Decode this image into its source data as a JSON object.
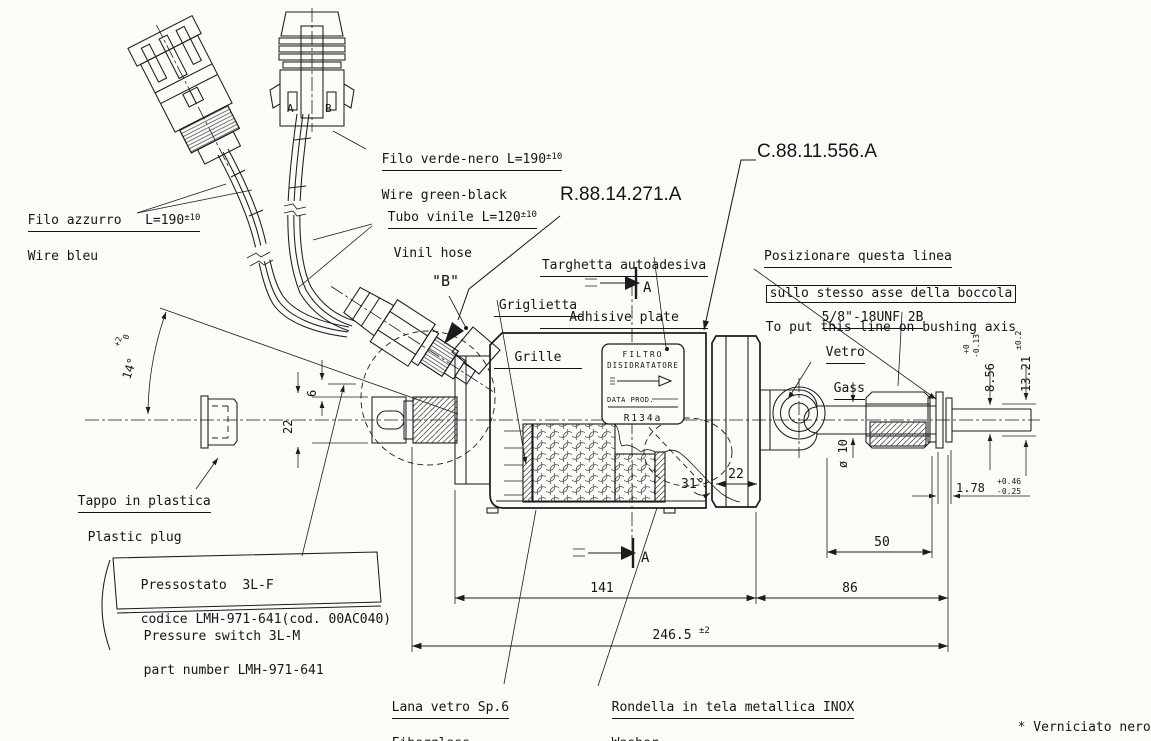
{
  "callouts": {
    "part_number_switch": "R.88.14.271.A",
    "part_number_filter": "C.88.11.556.A",
    "filo_azzurro_it": "Filo azzurro   ",
    "filo_azzurro_len": "L=190",
    "filo_azzurro_tol": "±10",
    "filo_azzurro_en": "Wire bleu",
    "filo_verde_it": "Filo verde-nero ",
    "filo_verde_len": "L=190",
    "filo_verde_tol": "±10",
    "filo_verde_en": "Wire green-black",
    "tubo_it": "Tubo vinile ",
    "tubo_len": "L=120",
    "tubo_tol": "±10",
    "tubo_en": "Vinil hose",
    "targhetta_it": "Targhetta autoadesiva",
    "targhetta_en": "Adhisive plate",
    "griglietta_it": "Griglietta",
    "griglietta_en": "Grille",
    "detail_b": "\"B\"",
    "posizionare_l1": "Posizionare questa linea",
    "posizionare_l2": "sullo stesso asse della boccola",
    "posizionare_l3": "To put this line on bushing axis",
    "thread_spec": "5/8\"-18UNF 2B",
    "vetro_it": "Vetro",
    "vetro_en": "Gass",
    "tappo_it": "Tappo in plastica",
    "tappo_en": "Plastic plug",
    "pressostato_l1": "Pressostato  3L-F",
    "pressostato_l2": "codice LMH-971-641(cod. 00AC040)",
    "pressostato_en1": "Pressure switch 3L-M",
    "pressostato_en2": "part number LMH-971-641",
    "lana_it": "Lana vetro Sp.6",
    "lana_en": "Fiberglass",
    "rondella_it": "Rondella in tela metallica INOX",
    "rondella_en": "Washer",
    "note_star_it": "* Verniciato nero",
    "note_star_en": "Black painted"
  },
  "plate": {
    "l1": "FILTRO",
    "l2": "DISIDRATATORE",
    "l3": "DATA PROD.",
    "l4": "R134a"
  },
  "connector": {
    "pin_a": "A",
    "pin_b": "B"
  },
  "section": {
    "label": "A"
  },
  "dims": {
    "len_body": "141",
    "len_right": "86",
    "len_total": "246.5",
    "len_total_tol": "±2",
    "len_pipe": "50",
    "cap_width": "22",
    "angle_cone": "31°",
    "pipe_dia": "ø 10",
    "d856": "8.56",
    "d856_tol_up": "+0",
    "d856_tol_dn": "-0.13",
    "d1321": "13.21",
    "d1321_tol": "±0.2",
    "d178": "1.78",
    "d178_tol_up": "+0.46",
    "d178_tol_dn": "-0.25",
    "tube_od": "22",
    "offset": "6",
    "angle_switch": "14°",
    "angle_switch_tol_up": "+2",
    "angle_switch_tol_dn": "0"
  },
  "ink": "#1c1c1c",
  "paper": "#fbfbf8"
}
